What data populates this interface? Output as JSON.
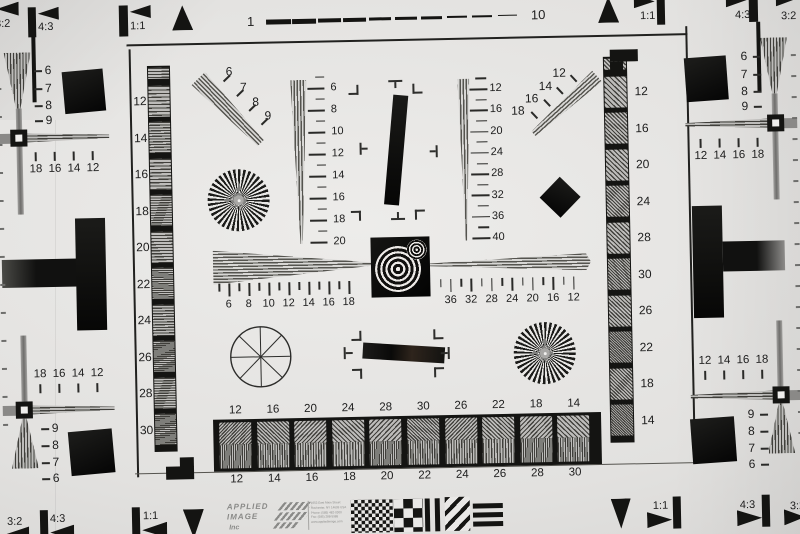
{
  "colors": {
    "ink": "#141412",
    "paper": "#e4e3e1",
    "stripe_dark": "#403f3b",
    "stripe_light": "#bdbcba",
    "gray_band": "#8a8987"
  },
  "markers": {
    "r32": "3:2",
    "r43": "4:3",
    "r11": "1:1"
  },
  "top_ruler": {
    "start": "1",
    "end": "10",
    "dash_count": 10
  },
  "scales": {
    "ladder_left": [
      "12",
      "14",
      "16",
      "18",
      "20",
      "22",
      "24",
      "26",
      "28",
      "30"
    ],
    "ladder_right": [
      "12",
      "16",
      "20",
      "24",
      "28",
      "30",
      "26",
      "22",
      "18",
      "14"
    ],
    "diag_upper_left": [
      "6",
      "7",
      "8",
      "9"
    ],
    "diag_upper_right": [
      "12",
      "14",
      "16",
      "18"
    ],
    "vert_center_left": [
      "6",
      "8",
      "10",
      "12",
      "14",
      "16",
      "18",
      "20"
    ],
    "vert_center_right": [
      "12",
      "16",
      "20",
      "24",
      "28",
      "32",
      "36",
      "40"
    ],
    "horiz_center_left": [
      "6",
      "8",
      "10",
      "12",
      "14",
      "16",
      "18"
    ],
    "horiz_center_right": [
      "36",
      "32",
      "28",
      "24",
      "20",
      "16",
      "12"
    ],
    "cross_top_left": [
      "18",
      "16",
      "14",
      "12"
    ],
    "cross_top_right": [
      "12",
      "14",
      "16",
      "18"
    ],
    "cross_bottom_left": [
      "18",
      "16",
      "14",
      "12"
    ],
    "cross_bottom_right": [
      "12",
      "14",
      "16",
      "18"
    ],
    "corner_top_left": [
      "6",
      "7",
      "8",
      "9"
    ],
    "corner_top_right": [
      "6",
      "7",
      "8",
      "9"
    ],
    "corner_bottom_left": [
      "9",
      "8",
      "7",
      "6"
    ],
    "corner_bottom_right": [
      "9",
      "8",
      "7",
      "6"
    ],
    "bar_top": [
      "12",
      "16",
      "20",
      "24",
      "28",
      "30",
      "26",
      "22",
      "18",
      "14"
    ],
    "bar_bottom": [
      "12",
      "14",
      "16",
      "18",
      "20",
      "22",
      "24",
      "26",
      "28",
      "30"
    ]
  },
  "logo": {
    "brand1": "APPLIED",
    "brand2": "IMAGE",
    "brand3": "Inc",
    "address": [
      "1653 East Main Street",
      "Rochester, NY 14609 USA",
      "Phone: (585) 482-0300",
      "Fax: (585) 288-5989",
      "www.appliedimage.com"
    ]
  }
}
